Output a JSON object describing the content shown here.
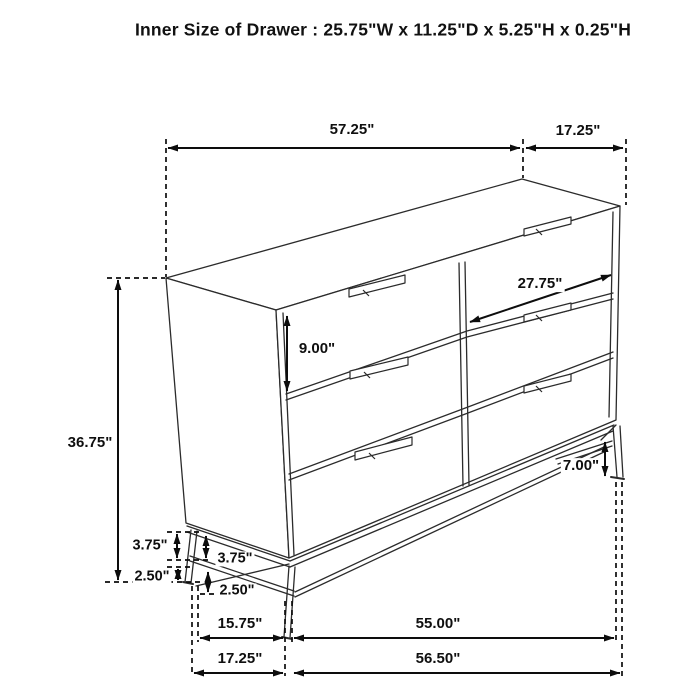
{
  "title": "Inner Size of Drawer : 25.75\"W x 11.25\"D x 5.25\"H x 0.25\"H",
  "dimension_labels": {
    "cabinet_width_top": "57.25\"",
    "cabinet_depth_top": "17.25\"",
    "drawer_front_width": "27.75\"",
    "drawer_front_height": "9.00\"",
    "overall_height": "36.75\"",
    "base_height_right": "7.00\"",
    "base_upper_outer": "3.75\"",
    "base_upper_inner": "3.75\"",
    "base_lower_outer": "2.50\"",
    "base_lower_inner": "2.50\"",
    "base_leg_span_depth": "15.75\"",
    "base_leg_span_width": "55.00\"",
    "floor_depth": "17.25\"",
    "floor_width": "56.50\""
  },
  "colors": {
    "line": "#2b2b2b",
    "dimension": "#0d0d0d",
    "text": "#111111",
    "background": "#ffffff"
  }
}
